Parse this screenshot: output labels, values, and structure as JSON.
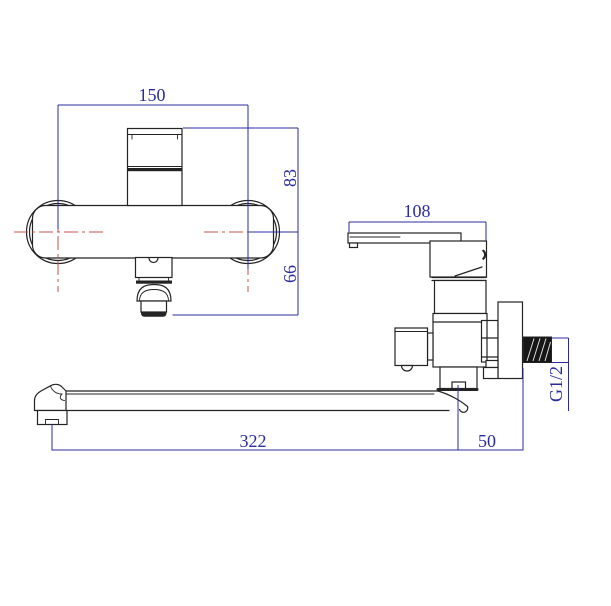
{
  "dimensions": {
    "front_width": "150",
    "front_upper_height": "83",
    "front_lower_height": "66",
    "handle_length": "108",
    "thread_size": "G1/2",
    "spout_length": "322",
    "wall_offset": "50"
  },
  "colors": {
    "outline": "#232323",
    "dimension": "#2b2ba0",
    "centerline": "#c9514f",
    "background": "#ffffff",
    "thread": "#161616"
  }
}
